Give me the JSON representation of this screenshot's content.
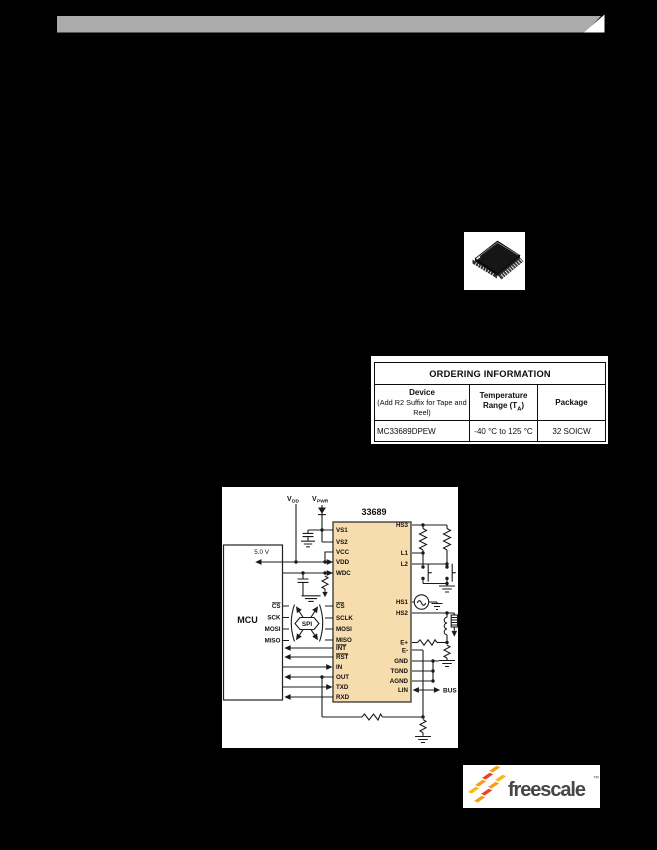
{
  "page": {
    "background": "#000000",
    "bar_color": "#ababab"
  },
  "ordering_table": {
    "title": "ORDERING INFORMATION",
    "col1_header_line1": "Device",
    "col1_header_line2": "(Add R2 Suffix for Tape and Reel)",
    "col2_header_line1": "Temperature",
    "col2_header_line2_pre": "Range (T",
    "col2_header_sub": "A",
    "col2_header_line2_post": ")",
    "col3_header": "Package",
    "row": {
      "device": "MC33689DPEW",
      "temperature": "-40 °C to 125 °C",
      "package": "32 SOICW"
    }
  },
  "diagram": {
    "part_number": "33689",
    "mcu_label": "MCU",
    "supply_5v": "5.0 V",
    "vdd_main": "V",
    "vdd_sub": "DD",
    "vpwr_main": "V",
    "vpwr_sub": "PWR",
    "spi_label": "SPI",
    "bus_label": "BUS",
    "ic_fill": "#f7dcae",
    "mcu_pins": [
      {
        "label": "CS",
        "overbar": true
      },
      {
        "label": "SCK"
      },
      {
        "label": "MOSI"
      },
      {
        "label": "MISO"
      }
    ],
    "ic_left_pins": [
      {
        "label": "VS1"
      },
      {
        "label": "VS2"
      },
      {
        "label": "VCC"
      },
      {
        "label": "VDD"
      },
      {
        "label": "WDC"
      },
      {
        "label": "CS",
        "overbar": true
      },
      {
        "label": "SCLK"
      },
      {
        "label": "MOSI"
      },
      {
        "label": "MISO"
      },
      {
        "label": "INT",
        "overbar": true
      },
      {
        "label": "RST",
        "overbar": true
      },
      {
        "label": "IN"
      },
      {
        "label": "OUT"
      },
      {
        "label": "TXD"
      },
      {
        "label": "RXD"
      }
    ],
    "ic_right_pins": [
      {
        "label": "HS3"
      },
      {
        "label": "L1"
      },
      {
        "label": "L2"
      },
      {
        "label": "HS1"
      },
      {
        "label": "HS2"
      },
      {
        "label": "E+"
      },
      {
        "label": "E-"
      },
      {
        "label": "GND"
      },
      {
        "label": "TGND"
      },
      {
        "label": "AGND"
      },
      {
        "label": "LIN"
      }
    ]
  },
  "logo": {
    "wordmark": "freescale",
    "trademark": "™",
    "colors": {
      "orange": "#F6A01A",
      "red": "#EF4123",
      "yellow": "#FDB913"
    }
  },
  "figures": {
    "chip_icon": "soic-32-package-isometric",
    "header_bar": "gray-banner-with-notch"
  }
}
